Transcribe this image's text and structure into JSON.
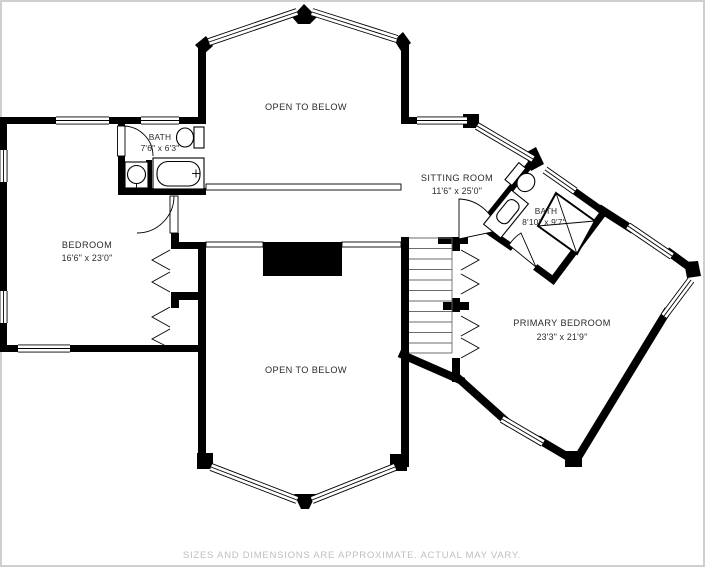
{
  "plan": {
    "type": "floor-plan",
    "rooms": {
      "open_to_below_top": {
        "name": "OPEN TO BELOW"
      },
      "bath_upper": {
        "name": "BATH",
        "dims": "7'6\" x 6'3\""
      },
      "bedroom": {
        "name": "BEDROOM",
        "dims": "16'6\" x 23'0\""
      },
      "sitting_room": {
        "name": "SITTING ROOM",
        "dims": "11'6\" x 25'0\""
      },
      "bath_primary": {
        "name": "BATH",
        "dims": "8'10\" x 9'7\""
      },
      "primary_bedroom": {
        "name": "PRIMARY BEDROOM",
        "dims": "23'3\" x 21'9\""
      },
      "open_to_below_bottom": {
        "name": "OPEN TO BELOW"
      }
    },
    "footer": {
      "disclaimer": "SIZES AND DIMENSIONS ARE APPROXIMATE. ACTUAL MAY VARY."
    },
    "colors": {
      "wall": "#000000",
      "background": "#ffffff",
      "label_text": "#2b2b2b",
      "footer_text": "#bfbfbf",
      "stair_line": "#6b6b6b"
    }
  }
}
